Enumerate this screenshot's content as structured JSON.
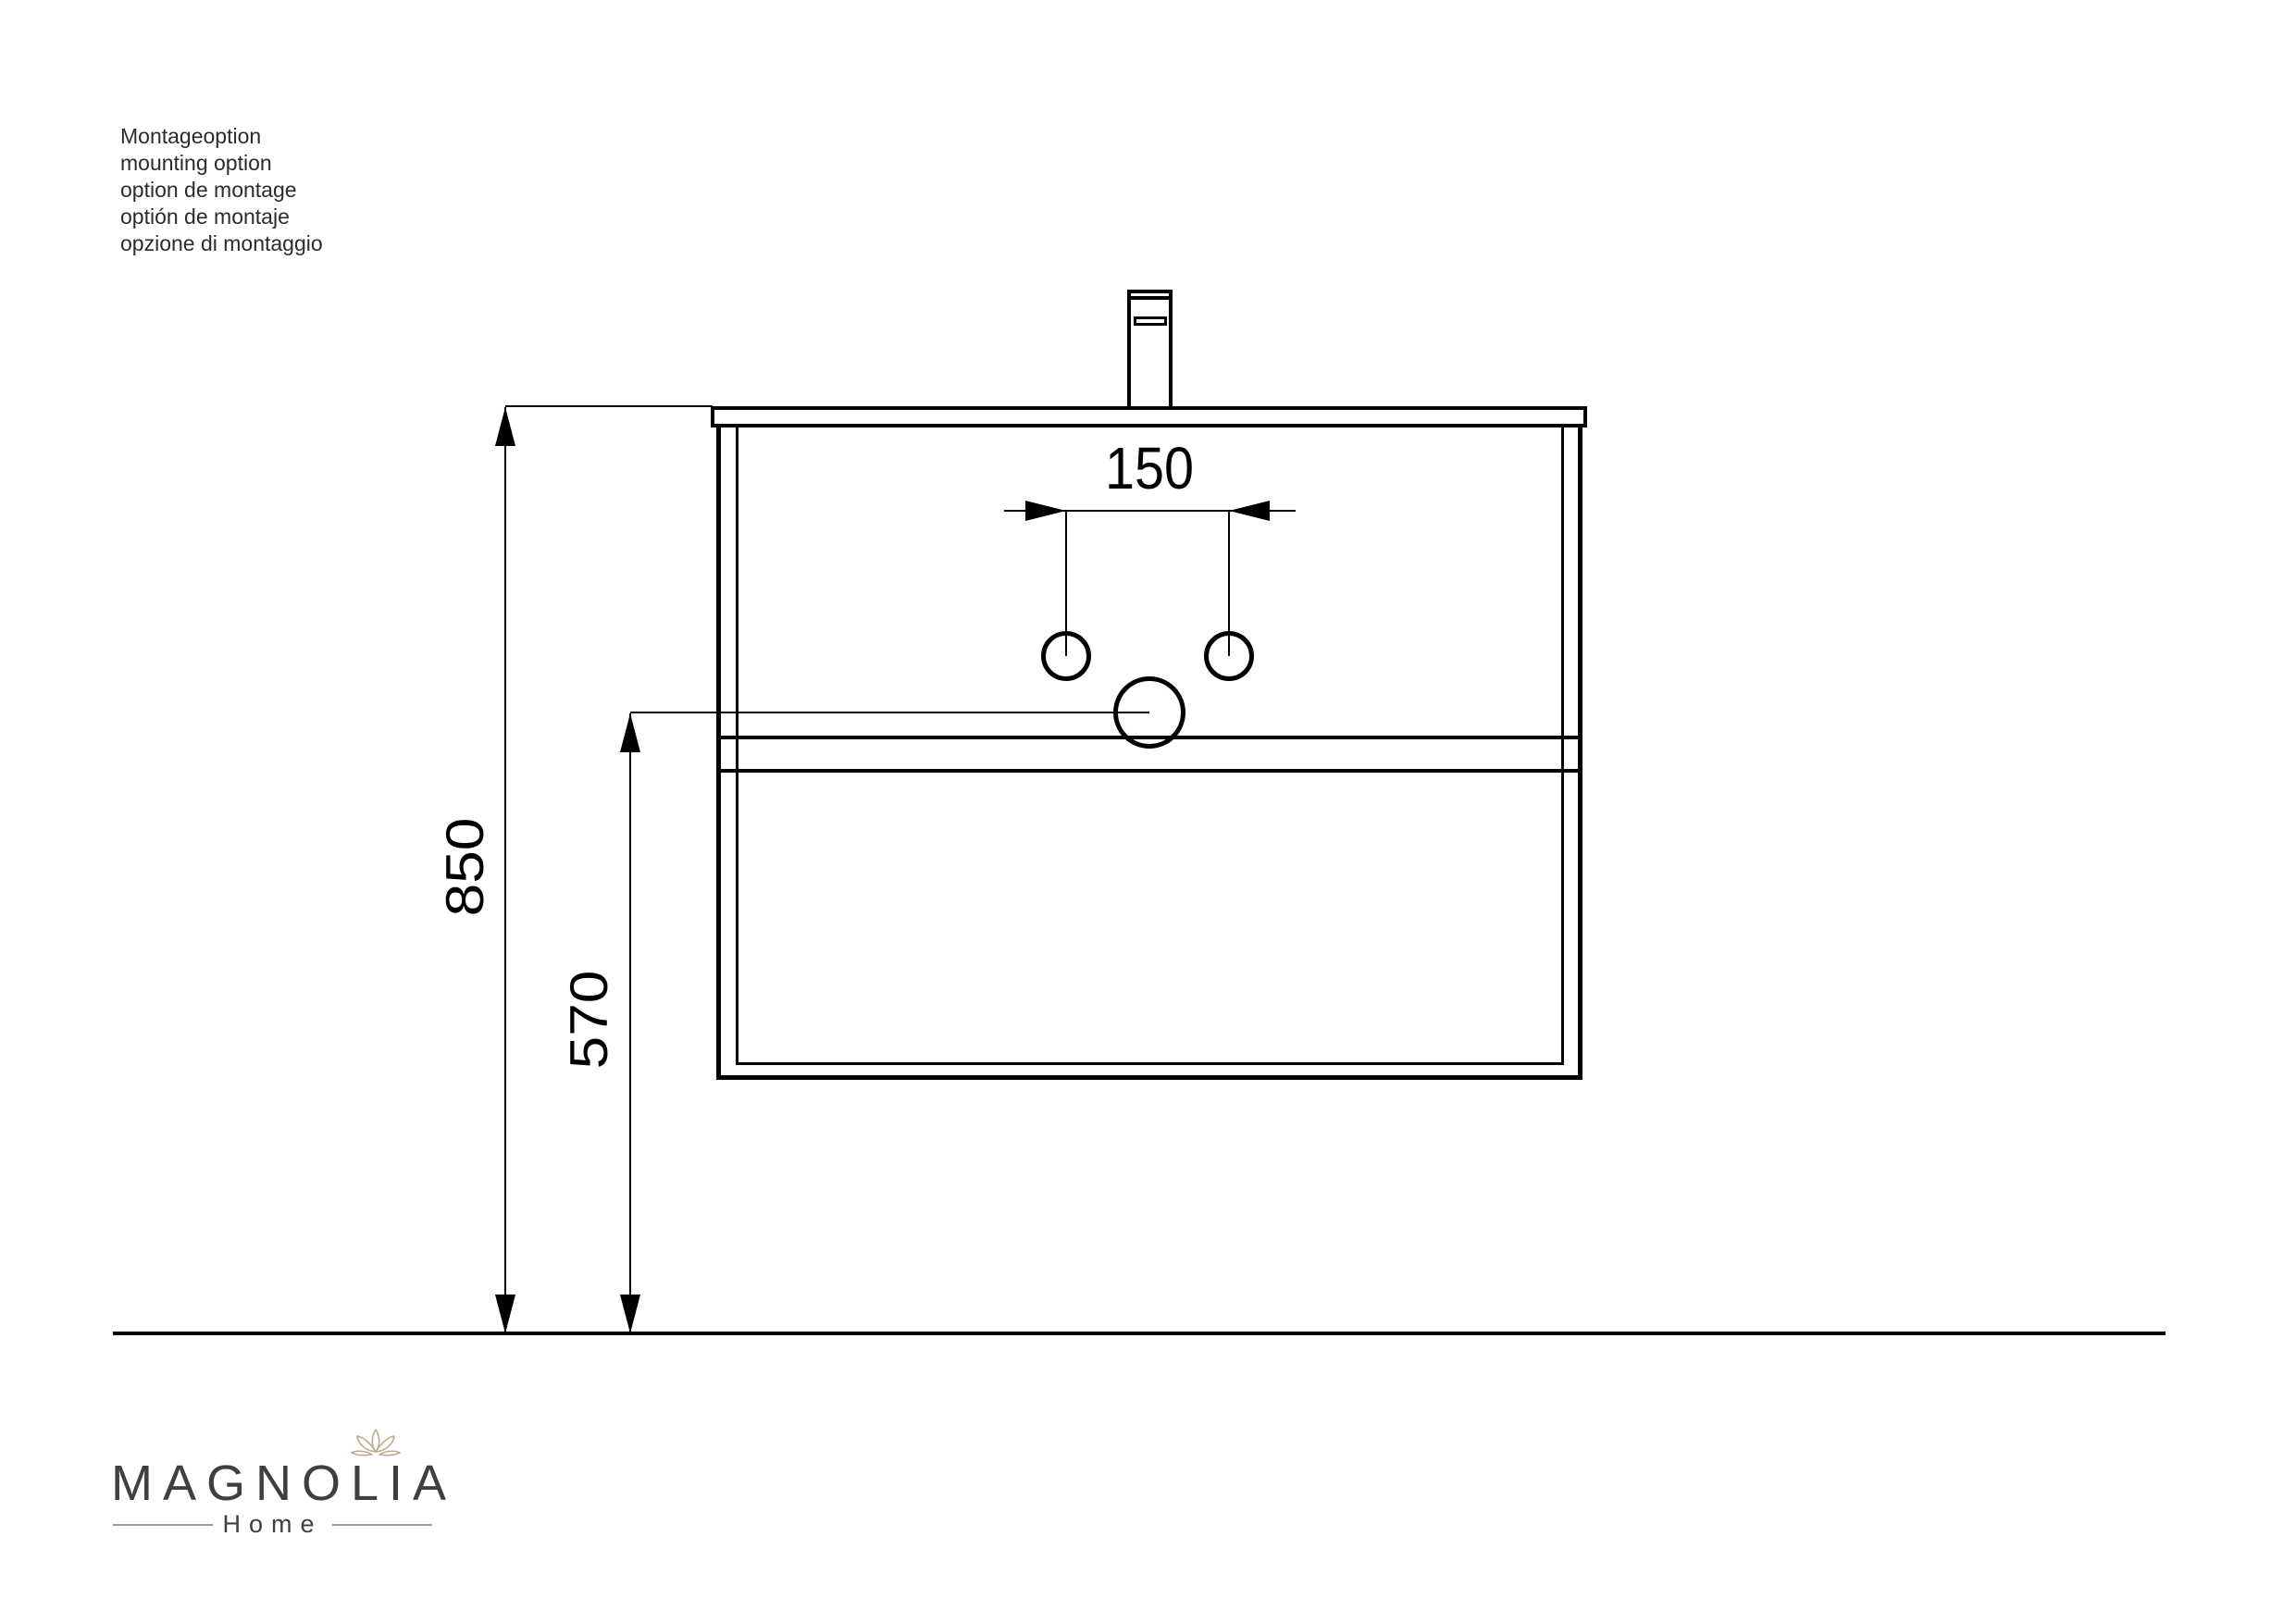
{
  "notes": {
    "lines": [
      "Montageoption",
      "mounting option",
      "option de montage",
      "optión de montaje",
      "opzione di montaggio"
    ]
  },
  "dims": {
    "hole_spacing": "150",
    "mounting_height": "850",
    "drain_height": "570"
  },
  "logo": {
    "brand": "MAGNOLIA",
    "subtitle": "Home"
  },
  "icons": {
    "lotus": "lotus-icon"
  },
  "colors": {
    "line": "#000000",
    "note_text": "#2b2b2b",
    "dim_text": "#000000",
    "logo_text": "#3f3f3f",
    "logo_accent": "#c3a98c",
    "background": "#ffffff",
    "rule_gray": "#9a9a9a"
  }
}
